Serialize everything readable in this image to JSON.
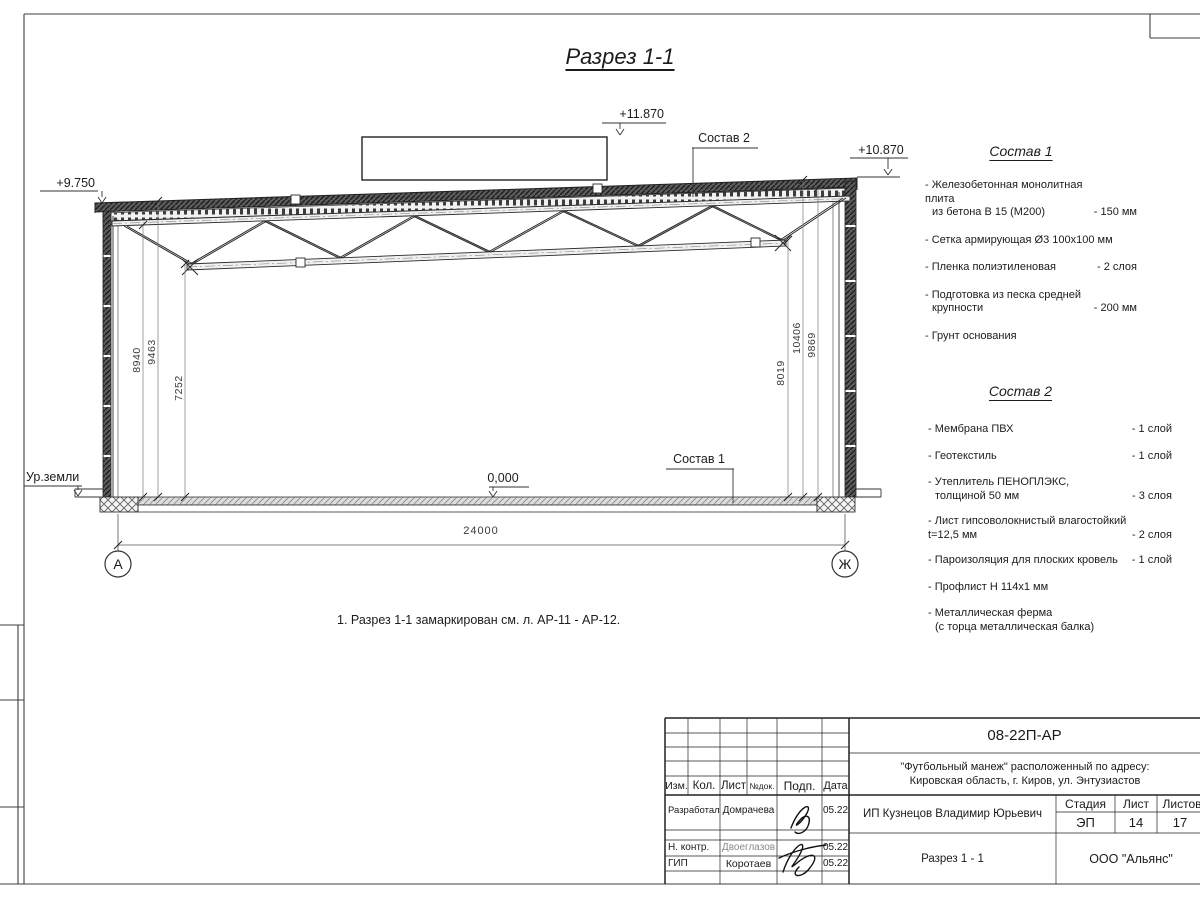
{
  "page": {
    "title": "Разрез 1-1",
    "note": "1. Разрез 1-1 замаркирован см. л. АР-11 - АР-12."
  },
  "marks": {
    "elev_left": "+9.750",
    "elev_ridge": "+11.870",
    "elev_right": "+10.870",
    "elev_zero": "0,000",
    "ground": "Ур.земли",
    "leader_roof": "Состав 2",
    "leader_floor": "Состав 1",
    "span": "24000",
    "dims_left": [
      "8940",
      "9463",
      "7252"
    ],
    "dims_right": [
      "8019",
      "10406",
      "9869"
    ],
    "axis_left": "А",
    "axis_right": "Ж"
  },
  "sostav1": {
    "heading": "Состав 1",
    "items": [
      {
        "l1": "- Железобетонная  монолитная плита",
        "l2": "из бетона В 15 (М200)",
        "v": "- 150 мм"
      },
      {
        "l1": "- Сетка армирующая Ø3 100х100 мм",
        "l2": "",
        "v": ""
      },
      {
        "l1": "- Пленка полиэтиленовая",
        "l2": "",
        "v": "- 2 слоя"
      },
      {
        "l1": "- Подготовка из песка средней",
        "l2": "крупности",
        "v": "- 200 мм"
      },
      {
        "l1": "- Грунт основания",
        "l2": "",
        "v": ""
      }
    ]
  },
  "sostav2": {
    "heading": "Состав 2",
    "items": [
      {
        "l1": "- Мембрана ПВХ",
        "l2": "",
        "v": "- 1 слой"
      },
      {
        "l1": "- Геотекстиль",
        "l2": "",
        "v": "- 1 слой"
      },
      {
        "l1": "- Утеплитель ПЕНОПЛЭКС,",
        "l2": "толщиной 50 мм",
        "v": "- 3 слоя"
      },
      {
        "l1": "- Лист гипсоволокнистый влагостойкий",
        "l2": "t=12,5 мм",
        "v": "- 2 слоя"
      },
      {
        "l1": "- Пароизоляция для плоских кровель",
        "l2": "",
        "v": "- 1 слой"
      },
      {
        "l1": "- Профлист Н 114х1 мм",
        "l2": "",
        "v": ""
      },
      {
        "l1": "- Металлическая ферма",
        "l2": "(с торца металлическая балка)",
        "v": ""
      }
    ]
  },
  "titleblock": {
    "doc_number": "08-22П-АР",
    "project_line1": "\"Футбольный манеж\" расположенный по адресу:",
    "project_line2": "Кировская область, г. Киров, ул. Энтузиастов",
    "client": "ИП Кузнецов Владимир Юрьевич",
    "sheet_title": "Разрез 1 - 1",
    "company": "ООО \"Альянс\"",
    "cols": {
      "izm": "Изм.",
      "kol": "Кол.",
      "list": "Лист",
      "ndok": "№док.",
      "podp": "Подп.",
      "data": "Дата"
    },
    "stage_cols": {
      "stage": "Стадия",
      "sheet": "Лист",
      "sheets": "Листов"
    },
    "stage": "ЭП",
    "sheet_no": "14",
    "sheets_total": "17",
    "rows": [
      {
        "role": "Разработал",
        "name": "Домрачева",
        "date": "05.22"
      },
      {
        "role": "Н. контр.",
        "name": "Двоеглазов",
        "date": "05.22"
      },
      {
        "role": "ГИП",
        "name": "Коротаев",
        "date": "05.22"
      }
    ]
  }
}
